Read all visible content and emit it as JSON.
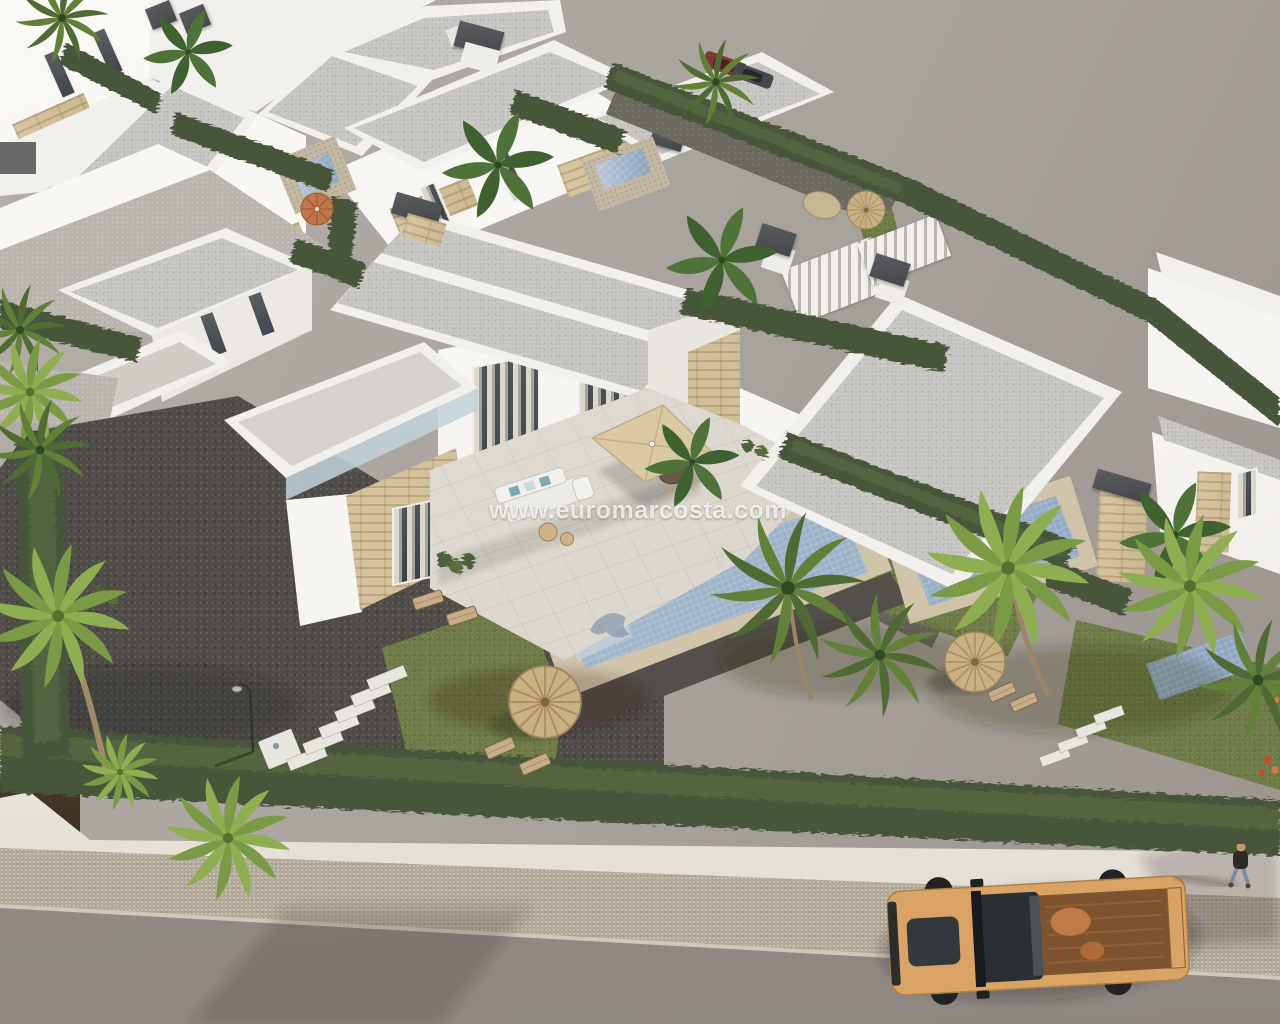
{
  "image": {
    "kind": "3d-architectural-aerial-render",
    "subject": "New-build development of modern white villas with flat roofs, travertine stone accents, private mosaic pools, landscaped gardens with palms and cypress hedges, a perimeter wall along a street with a tan pickup truck and a pedestrian",
    "view": "high-angle aerial perspective"
  },
  "watermark": {
    "text": "www.euromarcosta.com"
  },
  "objects": [
    "modern white villas with flat solarium roofs",
    "travertine stone wall accents",
    "roof access stairs and chimney caps",
    "private swimming pools with mosaic lining",
    "beige pool decks and dark wet decks",
    "lawns, cypress hedges and palm trees",
    "thatch straw parasols with wooden sun loungers",
    "terracotta parasol",
    "outdoor lounge sofa with teal cushions",
    "dining set under beige pergola canopy",
    "gravel driveway with white stepping stones",
    "street lamp",
    "white perimeter wall with hedge and dark gate",
    "sidewalk and asphalt road",
    "tan double-cab pickup truck",
    "pedestrian walking on sidewalk",
    "parked cars behind boundary fence"
  ],
  "colors": {
    "backdrop1": "#b5afaa",
    "backdrop2": "#9c958f",
    "road1": "#a39b95",
    "road2": "#8e8781",
    "sidewalk": "#b3aa9b",
    "curb": "#cfc8bb",
    "wall": "#f2efe8",
    "gate": "#3a2e22",
    "hedge": "#47553a",
    "hedgeLight": "#5f7045",
    "grass": "#6e7a47",
    "gravel": "#504d49",
    "pathLight": "#b9b4ad",
    "terrace": "#dcd7ce",
    "deck": "#cdc0a6",
    "wetdeck": "#53504b",
    "pool1": "#b9c6d4",
    "pool2": "#8aa2bd",
    "roofGray": "#c6c4c1",
    "roofWhite": "#f2f0ed",
    "facade": "#f6f4f0",
    "facadeShade": "#e3dfd9",
    "stoneA": "#d8c7a2",
    "stoneB": "#c9b78f",
    "glass": "#3c4147",
    "curtain": "#ddd6c8",
    "canopy": "#dbc9a3",
    "straw": "#c9b183",
    "orange": "#c0764d",
    "palmDark": "#4f6a33",
    "palmMid": "#628038",
    "palmLight": "#7b9a46",
    "banana": "#3f6130",
    "trunk": "#9b8568",
    "truckBody": "#d9a365",
    "truckBed": "#7e5430",
    "truckGlass": "#2a2f33"
  }
}
